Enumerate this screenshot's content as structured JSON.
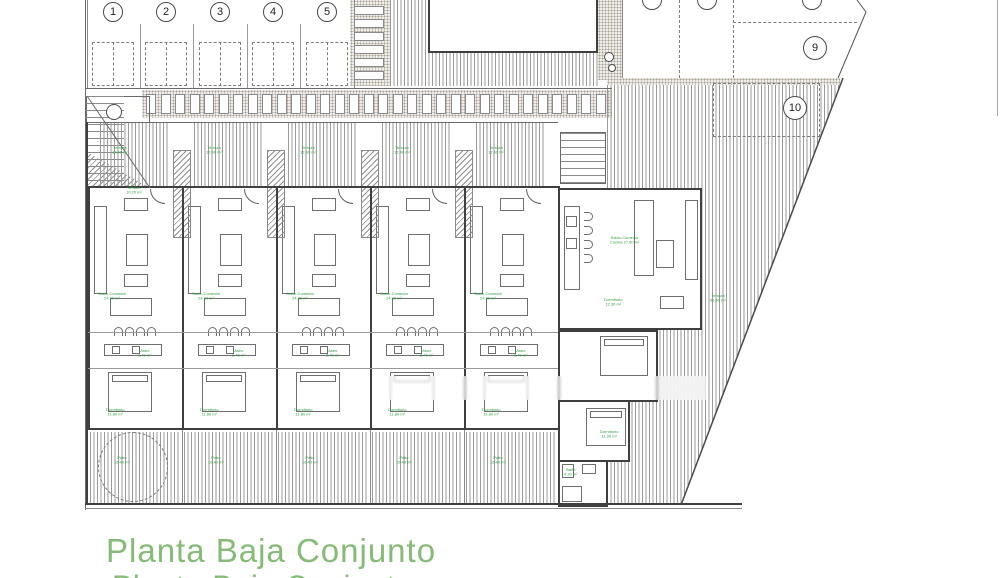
{
  "title": {
    "line1": "Planta Baja Conjunto",
    "line2_clipped": "Planta Baja Conjunto"
  },
  "colors": {
    "label_green": "#2f9e3f",
    "title_green": "#85bb76",
    "wall_dark": "#3f3f3f"
  },
  "parking": {
    "stalls": [
      {
        "num": "1",
        "cx": 113
      },
      {
        "num": "2",
        "cx": 166
      },
      {
        "num": "3",
        "cx": 220
      },
      {
        "num": "4",
        "cx": 273
      },
      {
        "num": "5",
        "cx": 327
      }
    ],
    "zone_markers": [
      {
        "num": "9",
        "cx": 815,
        "cy": 48
      },
      {
        "num": "10",
        "cx": 795,
        "cy": 108
      }
    ],
    "clipped_markers": [
      {
        "cx": 652
      },
      {
        "cx": 707
      },
      {
        "cx": 812
      }
    ]
  },
  "room_labels": [
    {
      "text": "Terraza\n12.40 m²",
      "x": 112,
      "y": 146
    },
    {
      "text": "Terraza\n12.40 m²",
      "x": 206,
      "y": 146
    },
    {
      "text": "Terraza\n12.40 m²",
      "x": 300,
      "y": 146
    },
    {
      "text": "Terraza\n12.40 m²",
      "x": 394,
      "y": 146
    },
    {
      "text": "Terraza\n12.40 m²",
      "x": 488,
      "y": 146
    },
    {
      "text": "Salón-Comedor\n24.30 m²",
      "x": 98,
      "y": 292
    },
    {
      "text": "Salón-Comedor\n24.30 m²",
      "x": 192,
      "y": 292
    },
    {
      "text": "Salón-Comedor\n24.30 m²",
      "x": 286,
      "y": 292
    },
    {
      "text": "Salón-Comedor\n24.30 m²",
      "x": 380,
      "y": 292
    },
    {
      "text": "Salón-Comedor\n24.30 m²",
      "x": 474,
      "y": 292
    },
    {
      "text": "Aseo\n2.40 m²",
      "x": 138,
      "y": 349
    },
    {
      "text": "Aseo\n2.40 m²",
      "x": 232,
      "y": 349
    },
    {
      "text": "Aseo\n2.40 m²",
      "x": 326,
      "y": 349
    },
    {
      "text": "Aseo\n2.40 m²",
      "x": 420,
      "y": 349
    },
    {
      "text": "Aseo\n2.40 m²",
      "x": 514,
      "y": 349
    },
    {
      "text": "Dormitorio\n11.80 m²",
      "x": 106,
      "y": 408
    },
    {
      "text": "Dormitorio\n11.80 m²",
      "x": 200,
      "y": 408
    },
    {
      "text": "Dormitorio\n11.80 m²",
      "x": 294,
      "y": 408
    },
    {
      "text": "Dormitorio\n11.80 m²",
      "x": 388,
      "y": 408
    },
    {
      "text": "Dormitorio\n11.80 m²",
      "x": 482,
      "y": 408
    },
    {
      "text": "Patio\n16.40 m²",
      "x": 114,
      "y": 456
    },
    {
      "text": "Patio\n16.40 m²",
      "x": 208,
      "y": 456
    },
    {
      "text": "Patio\n16.40 m²",
      "x": 302,
      "y": 456
    },
    {
      "text": "Patio\n16.40 m²",
      "x": 396,
      "y": 456
    },
    {
      "text": "Patio\n16.40 m²",
      "x": 490,
      "y": 456
    },
    {
      "text": "Salón-Comedor\nCocina 27.60 m²",
      "x": 610,
      "y": 236
    },
    {
      "text": "Dormitorio\n12.30 m²",
      "x": 604,
      "y": 298
    },
    {
      "text": "Dormitorio\n11.90 m²",
      "x": 600,
      "y": 430
    },
    {
      "text": "Baño\n4.20 m²",
      "x": 564,
      "y": 468
    },
    {
      "text": "Terraza\n96.40 m²",
      "x": 710,
      "y": 294
    },
    {
      "text": "Terraza\n10.20 m²",
      "x": 126,
      "y": 186
    }
  ]
}
